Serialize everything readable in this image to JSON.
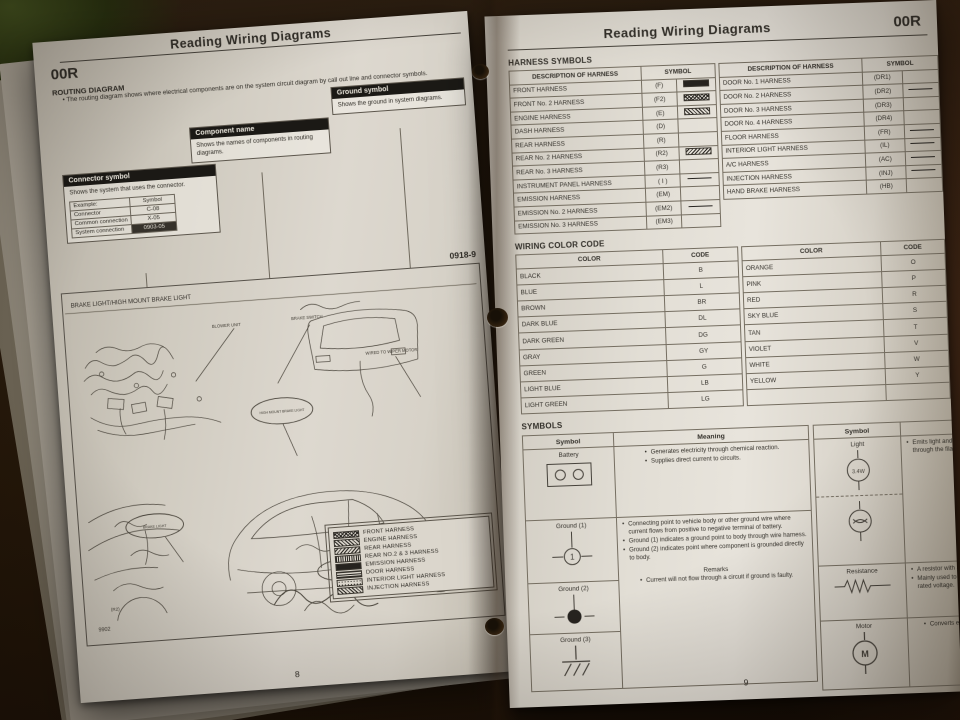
{
  "book": {
    "left_page": {
      "section_code": "00R",
      "title": "Reading Wiring Diagrams",
      "routing": {
        "heading": "ROUTING DIAGRAM",
        "bullet": "The routing diagram shows where electrical components are on the system circuit diagram by call out line and connector symbols."
      },
      "callouts": {
        "connector": {
          "title": "Connector symbol",
          "body": "Shows the system that uses the connector.",
          "example_label": "Example:",
          "symbol_header": "Symbol",
          "rows": [
            [
              "Connector",
              "C-08"
            ],
            [
              "Common connection",
              "X-05"
            ],
            [
              "System connection",
              "0903-05"
            ]
          ]
        },
        "component": {
          "title": "Component name",
          "body": "Shows the names of components in routing diagrams."
        },
        "ground": {
          "title": "Ground symbol",
          "body": "Shows the ground in system diagrams."
        }
      },
      "figure": {
        "caption": "BRAKE LIGHT/HIGH MOUNT BRAKE LIGHT",
        "fig_no": "0918-9",
        "corner_note": "9902",
        "labels": [
          "BLOWER UNIT",
          "BRAKE SWITCH",
          "WIRED TO WIPER MOTOR",
          "HIGH MOUNT BRAKE LIGHT",
          "BRAKE LIGHT",
          "(HB)",
          "(R2)"
        ],
        "legend": [
          "FRONT HARNESS",
          "ENGINE HARNESS",
          "REAR HARNESS",
          "REAR NO.2 & 3 HARNESS",
          "EMISSION HARNESS",
          "DOOR HARNESS",
          "INTERIOR LIGHT HARNESS",
          "INJECTION HARNESS"
        ]
      },
      "page_number": "8"
    },
    "right_page": {
      "section_code": "00R",
      "title": "Reading Wiring Diagrams",
      "harness_symbols": {
        "heading": "HARNESS SYMBOLS",
        "col_desc": "DESCRIPTION OF HARNESS",
        "col_symbol": "SYMBOL",
        "left_rows": [
          [
            "FRONT HARNESS",
            "(F)",
            "solid"
          ],
          [
            "FRONT No. 2 HARNESS",
            "(F2)",
            "cross"
          ],
          [
            "ENGINE HARNESS",
            "(E)",
            "hatch"
          ],
          [
            "DASH HARNESS",
            "(D)",
            ""
          ],
          [
            "REAR HARNESS",
            "(R)",
            ""
          ],
          [
            "REAR No. 2 HARNESS",
            "(R2)",
            "hatch2"
          ],
          [
            "REAR No. 3 HARNESS",
            "(R3)",
            ""
          ],
          [
            "INSTRUMENT PANEL HARNESS",
            "( I )",
            "dash"
          ],
          [
            "EMISSION HARNESS",
            "(EM)",
            ""
          ],
          [
            "EMISSION No. 2 HARNESS",
            "(EM2)",
            "dash"
          ],
          [
            "EMISSION No. 3 HARNESS",
            "(EM3)",
            ""
          ]
        ],
        "right_rows": [
          [
            "DOOR No. 1 HARNESS",
            "(DR1)",
            ""
          ],
          [
            "DOOR No. 2 HARNESS",
            "(DR2)",
            "dash"
          ],
          [
            "DOOR No. 3 HARNESS",
            "(DR3)",
            ""
          ],
          [
            "DOOR No. 4 HARNESS",
            "(DR4)",
            ""
          ],
          [
            "FLOOR HARNESS",
            "(FR)",
            "dash"
          ],
          [
            "INTERIOR LIGHT HARNESS",
            "(IL)",
            "dash"
          ],
          [
            "A/C HARNESS",
            "(AC)",
            "dash"
          ],
          [
            "INJECTION HARNESS",
            "(INJ)",
            "dash"
          ],
          [
            "HAND BRAKE HARNESS",
            "(HB)",
            ""
          ]
        ]
      },
      "wiring_color_code": {
        "heading": "WIRING COLOR CODE",
        "col_color": "COLOR",
        "col_code": "CODE",
        "left_rows": [
          [
            "BLACK",
            "B"
          ],
          [
            "BLUE",
            "L"
          ],
          [
            "BROWN",
            "BR"
          ],
          [
            "DARK BLUE",
            "DL"
          ],
          [
            "DARK GREEN",
            "DG"
          ],
          [
            "GRAY",
            "GY"
          ],
          [
            "GREEN",
            "G"
          ],
          [
            "LIGHT BLUE",
            "LB"
          ],
          [
            "LIGHT GREEN",
            "LG"
          ]
        ],
        "right_rows": [
          [
            "ORANGE",
            "O"
          ],
          [
            "PINK",
            "P"
          ],
          [
            "RED",
            "R"
          ],
          [
            "SKY BLUE",
            "S"
          ],
          [
            "TAN",
            "T"
          ],
          [
            "VIOLET",
            "V"
          ],
          [
            "WHITE",
            "W"
          ],
          [
            "YELLOW",
            "Y"
          ],
          [
            "",
            ""
          ]
        ]
      },
      "symbols": {
        "heading": "SYMBOLS",
        "col_symbol": "Symbol",
        "col_meaning": "Meaning",
        "battery": {
          "label": "Battery",
          "bullets": [
            "Generates electricity through chemical reaction.",
            "Supplies direct current to circuits."
          ]
        },
        "grounds": {
          "labels": [
            "Ground (1)",
            "Ground (2)",
            "Ground (3)"
          ],
          "bullets": [
            "Connecting point to vehicle body or other ground wire where current flows from positive to negative terminal of battery.",
            "Ground (1) indicates a ground point to body through wire harness.",
            "Ground (2) indicates point where component is grounded directly to body."
          ],
          "remarks_label": "Remarks",
          "remarks_list": [
            "Current will not flow through a circuit if ground is faulty."
          ]
        },
        "light": {
          "label": "Light",
          "wattage": "3.4W",
          "bullets": [
            "Emits light and generates heat when current flows through the filament."
          ]
        },
        "resistance": {
          "label": "Resistance",
          "bullets": [
            "A resistor with a constant resistance value.",
            "Mainly used to protect components in circuits from the rated voltage."
          ]
        },
        "motor": {
          "label": "Motor",
          "symbol_letter": "M",
          "bullets": [
            "Converts electrical energy to mechanical energy."
          ]
        }
      },
      "page_number": "9"
    }
  }
}
